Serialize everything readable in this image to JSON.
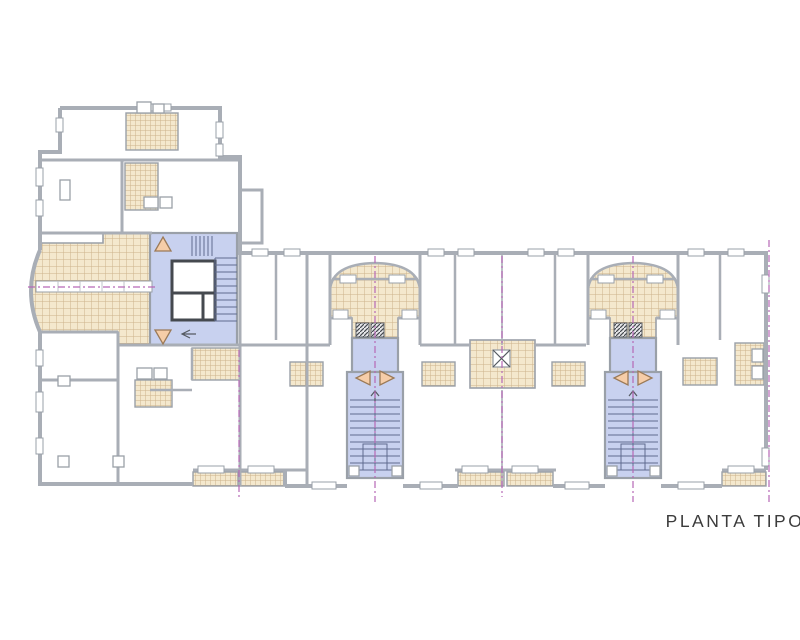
{
  "title": "PLANTA TIPO",
  "colors": {
    "background": "#ffffff",
    "wall": "#a9aeb6",
    "wall-light": "#bfc3c9",
    "outline": "#9aa0a8",
    "tile-fill": "#f4e8cd",
    "tile-grid": "#cdb28a",
    "core-fill": "#c8d1ef",
    "core-line": "#5f6b8f",
    "tri-fill": "#f6cda8",
    "tri-stroke": "#9b7a58",
    "axis": "#b668b6",
    "elevator": "#45494f",
    "text": "#3c3c3c"
  },
  "plan": {
    "drawing_type": "architectural floor plan",
    "areas": [
      {
        "name": "left-wing",
        "type": "apartment-rooms"
      },
      {
        "name": "stair-core-left",
        "type": "stairwell-with-elevator",
        "highlight": "blue"
      },
      {
        "name": "curved-terrace-left",
        "type": "tiled-terrace"
      },
      {
        "name": "arched-terrace-1",
        "type": "tiled-terrace"
      },
      {
        "name": "stair-core-1",
        "type": "stairwell",
        "highlight": "blue"
      },
      {
        "name": "arched-terrace-2",
        "type": "tiled-terrace"
      },
      {
        "name": "stair-core-2",
        "type": "stairwell",
        "highlight": "blue"
      },
      {
        "name": "interior-patio",
        "type": "tiled-lightwell"
      },
      {
        "name": "bathrooms",
        "type": "tiled-wet-rooms"
      },
      {
        "name": "balconies",
        "type": "tiled-balcony-strips"
      }
    ]
  }
}
